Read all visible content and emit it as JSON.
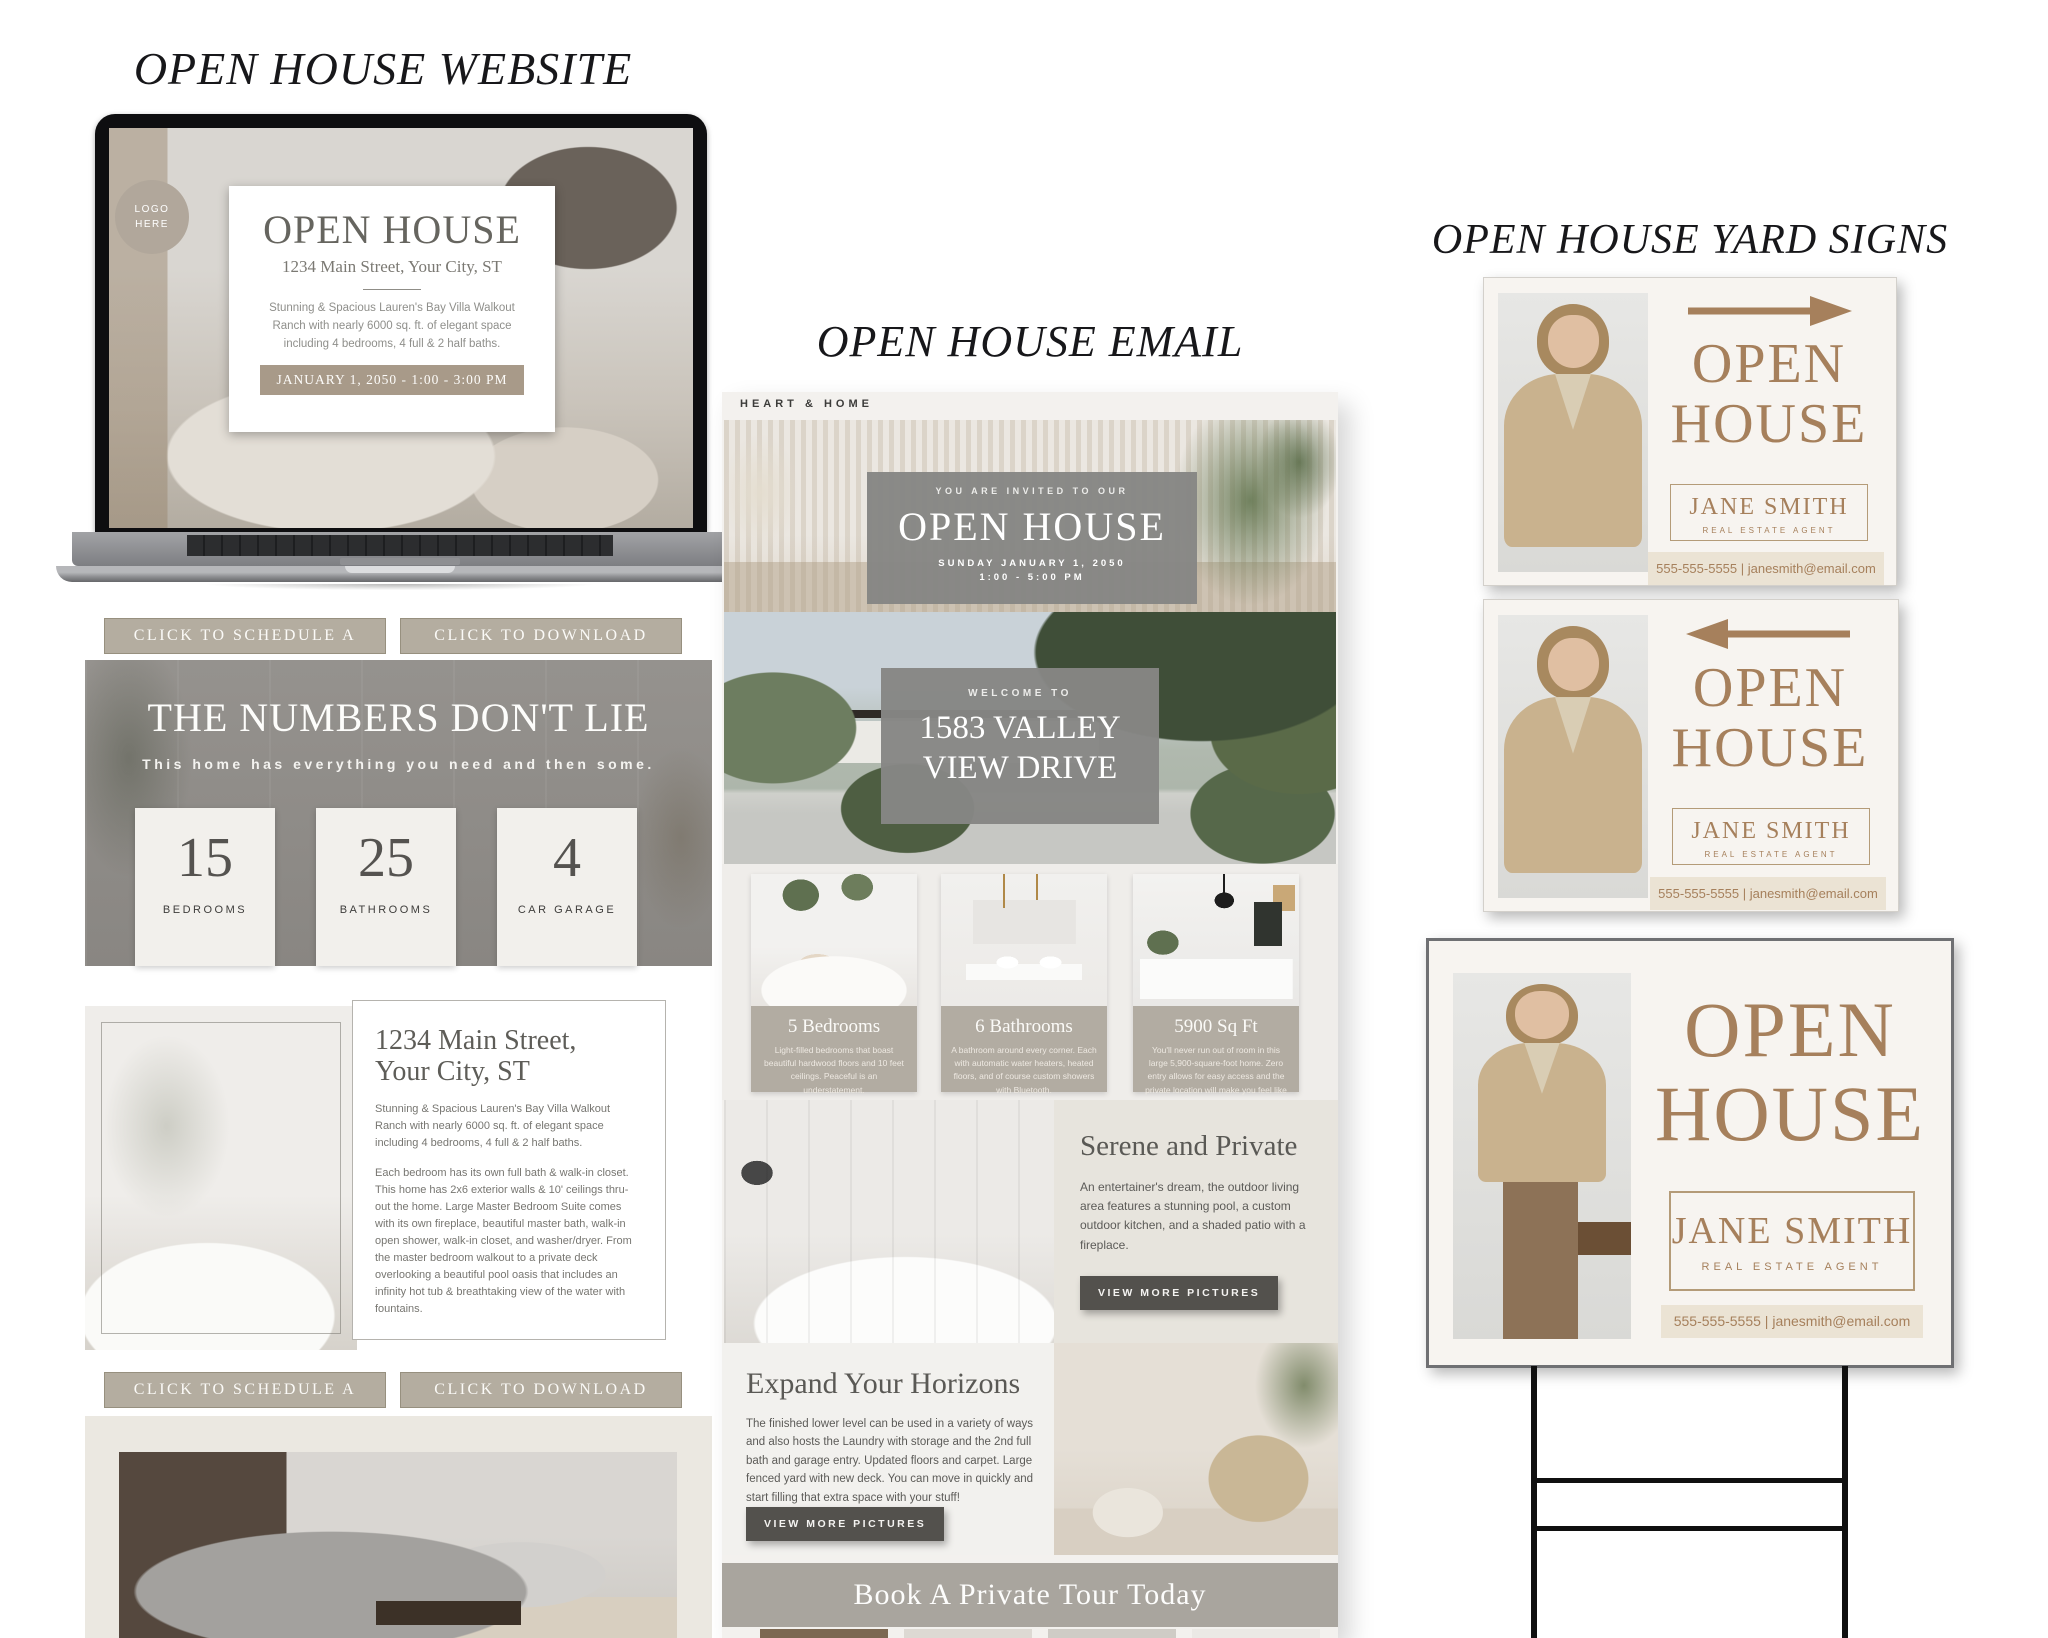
{
  "website": {
    "title": "OPEN HOUSE WEBSITE",
    "laptop": {
      "logo_badge": "LOGO\nHERE",
      "card": {
        "title": "OPEN HOUSE",
        "address": "1234 Main Street, Your City, ST",
        "description": "Stunning & Spacious Lauren's Bay Villa Walkout Ranch with nearly 6000 sq. ft. of elegant space including 4 bedrooms, 4 full & 2 half baths.",
        "date_badge": "JANUARY 1, 2050 - 1:00 - 3:00 PM"
      }
    },
    "buttons": {
      "schedule": "CLICK TO SCHEDULE A PRIVATE SHOWING",
      "download": "CLICK TO DOWNLOAD FLYER"
    },
    "numbers": {
      "title": "THE NUMBERS DON'T LIE",
      "subtitle": "This home has everything you need and then some.",
      "stats": [
        {
          "value": "15",
          "label": "BEDROOMS"
        },
        {
          "value": "25",
          "label": "BATHROOMS"
        },
        {
          "value": "4",
          "label": "CAR GARAGE"
        }
      ]
    },
    "listing": {
      "heading": "1234 Main Street,\nYour City, ST",
      "paragraph1": "Stunning & Spacious Lauren's Bay Villa Walkout Ranch with nearly 6000 sq. ft. of elegant space including 4 bedrooms, 4 full & 2 half baths.",
      "paragraph2": "Each bedroom has its own full bath & walk-in closet. This home has 2x6 exterior walls & 10' ceilings thru-out the home. Large Master Bedroom Suite comes with its own fireplace, beautiful master bath, walk-in open shower, walk-in closet, and washer/dryer. From the master bedroom walkout to a private deck overlooking a beautiful pool oasis that includes an infinity hot tub & breathtaking view of the water with fountains."
    }
  },
  "email": {
    "title": "OPEN HOUSE EMAIL",
    "brand": "HEART & HOME",
    "invite": {
      "eyebrow": "YOU ARE INVITED TO OUR",
      "heading": "OPEN HOUSE",
      "date": "SUNDAY JANUARY 1, 2050",
      "time": "1:00 - 5:00 PM"
    },
    "welcome": {
      "eyebrow": "WELCOME TO",
      "line1": "1583 VALLEY",
      "line2": "VIEW DRIVE"
    },
    "features": [
      {
        "title": "5 Bedrooms",
        "text": "Light-filled bedrooms that boast beautiful hardwood floors and 10 feet ceilings. Peaceful is an understatement."
      },
      {
        "title": "6 Bathrooms",
        "text": "A bathroom around every corner. Each with automatic water heaters, heated floors, and of course custom showers with Bluetooth."
      },
      {
        "title": "5900 Sq Ft",
        "text": "You'll never run out of room in this large 5,900-square-foot home. Zero entry allows for easy access and the private location will make you feel like you're on vacation!"
      }
    ],
    "serene": {
      "heading": "Serene and Private",
      "text": "An entertainer's dream, the outdoor living area features a stunning pool, a custom outdoor kitchen, and a shaded patio with a fireplace.",
      "button": "VIEW MORE PICTURES"
    },
    "expand": {
      "heading": "Expand Your Horizons",
      "text": "The finished lower level can be used in a variety of ways and also hosts the Laundry with storage and the 2nd full bath and garage entry. Updated floors and carpet. Large fenced yard with new deck. You can move in quickly and start filling that extra space with your stuff!",
      "button": "VIEW MORE PICTURES"
    },
    "cta": "Book A Private Tour Today"
  },
  "signs": {
    "title": "OPEN HOUSE YARD SIGNS",
    "line1": "OPEN",
    "line2": "HOUSE",
    "agent": "JANE SMITH",
    "role": "REAL ESTATE AGENT",
    "contact": "555-555-5555 | janesmith@email.com"
  },
  "icons": {
    "arrow_right": "→",
    "arrow_left": "←"
  },
  "colors": {
    "accent_brown": "#a6805c",
    "taupe_button": "#b4ada0",
    "overlay_gray": "#8a8a88",
    "feature_taupe": "#b2aca2",
    "dark_button": "#53514d",
    "cta_band": "#a9a59e"
  }
}
